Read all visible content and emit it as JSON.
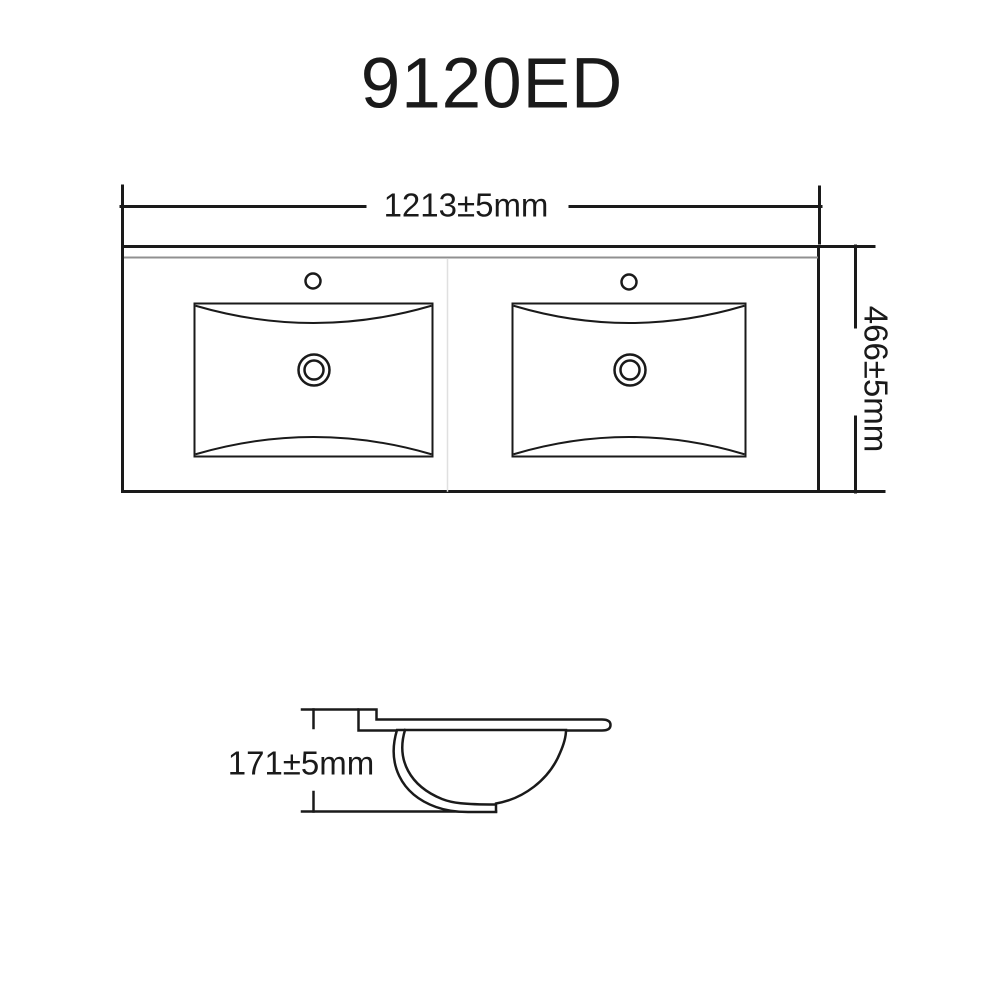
{
  "title": "9120ED",
  "top_view": {
    "width_label": "1213±5mm",
    "depth_label": "466±5mm"
  },
  "side_view": {
    "height_label": "171±5mm"
  },
  "colors": {
    "line": "#1a1a1a",
    "edge_highlight": "#909090",
    "seam": "#e0e0e0",
    "background": "#ffffff"
  }
}
